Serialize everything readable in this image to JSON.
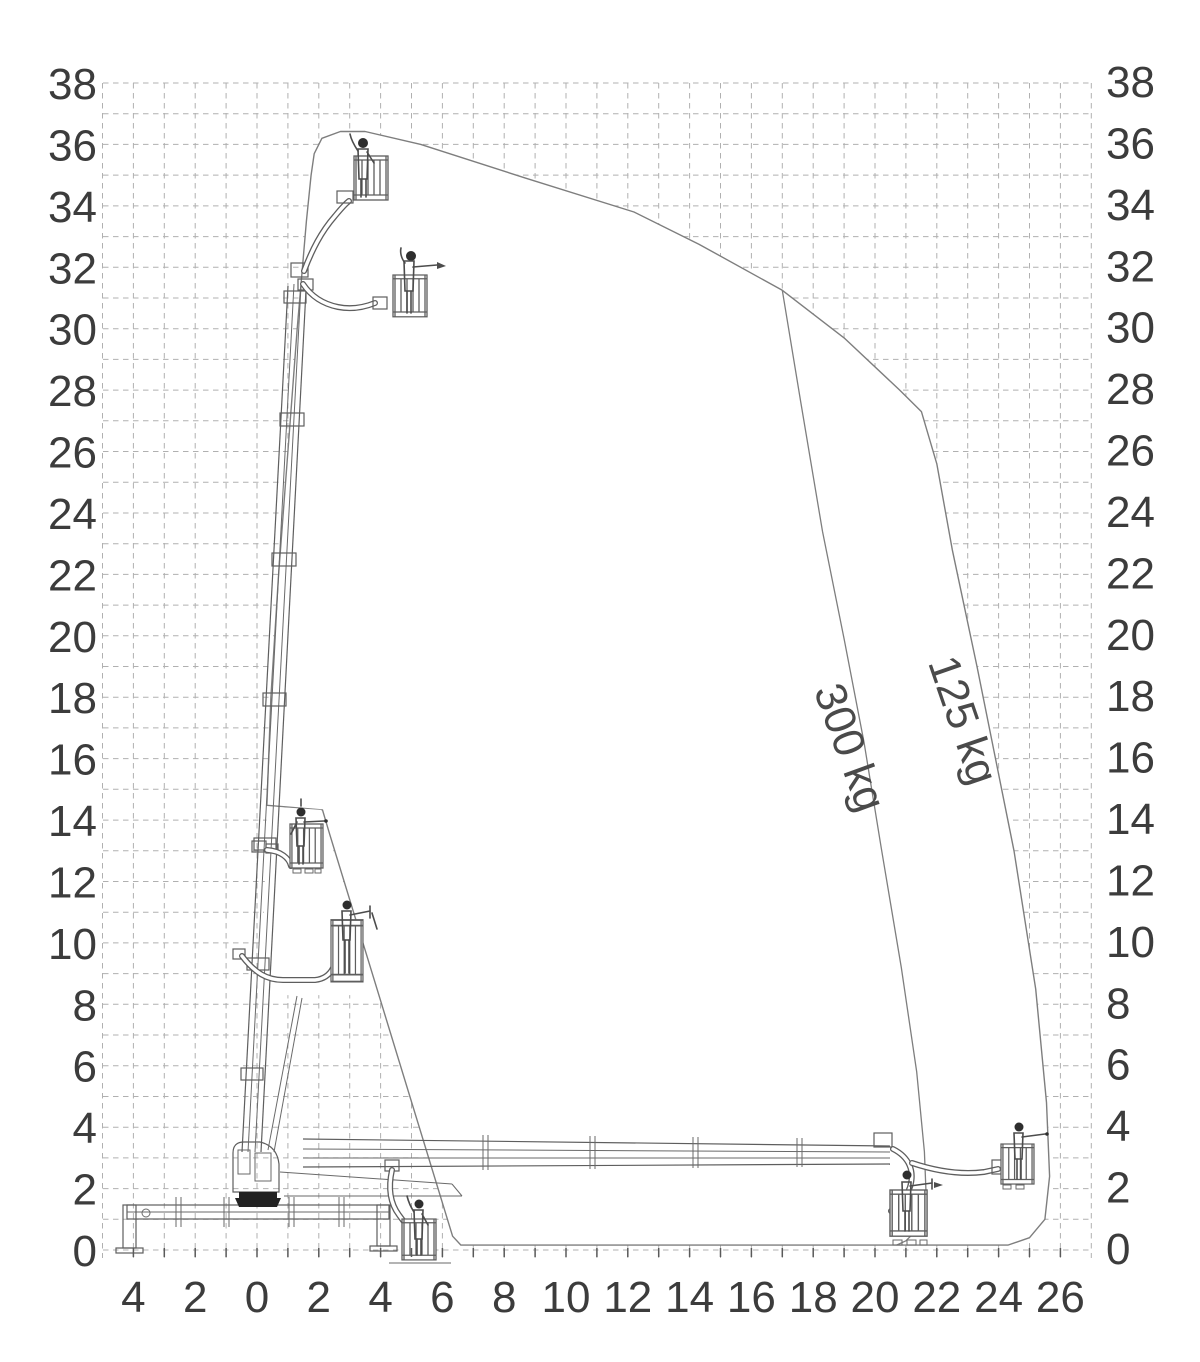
{
  "figure": {
    "kind": "aerial-work-platform working envelope diagram",
    "units": "m"
  },
  "chart_data": {
    "type": "area",
    "title": "",
    "xlabel": "",
    "ylabel": "",
    "x_axis": {
      "grid_range_m": [
        -5,
        27
      ],
      "tick_values": [
        -4,
        -2,
        0,
        2,
        4,
        6,
        8,
        10,
        12,
        14,
        16,
        18,
        20,
        22,
        24,
        26
      ],
      "tick_labels": [
        "4",
        "2",
        "0",
        "2",
        "4",
        "6",
        "8",
        "10",
        "12",
        "14",
        "16",
        "18",
        "20",
        "22",
        "24",
        "26"
      ],
      "minor_tick_step_m": 1
    },
    "y_axis": {
      "grid_range_m": [
        0,
        38
      ],
      "tick_values": [
        0,
        2,
        4,
        6,
        8,
        10,
        12,
        14,
        16,
        18,
        20,
        22,
        24,
        26,
        28,
        30,
        32,
        34,
        36,
        38
      ],
      "tick_labels": [
        "0",
        "2",
        "4",
        "6",
        "8",
        "10",
        "12",
        "14",
        "16",
        "18",
        "20",
        "22",
        "24",
        "26",
        "28",
        "30",
        "32",
        "34",
        "36",
        "38"
      ],
      "sides": [
        "left",
        "right"
      ]
    },
    "grid": {
      "spacing_m": 1,
      "style": "dashed",
      "on": true
    },
    "series": [
      {
        "name": "125 kg envelope",
        "load_kg": 125,
        "closed": true,
        "points_m": [
          [
            1.85,
            35.7
          ],
          [
            2.1,
            36.2
          ],
          [
            2.7,
            36.42
          ],
          [
            3.5,
            36.42
          ],
          [
            5.3,
            36.0
          ],
          [
            8.7,
            34.9
          ],
          [
            12.2,
            33.8
          ],
          [
            14.3,
            32.75
          ],
          [
            17.0,
            31.25
          ],
          [
            19.0,
            29.7
          ],
          [
            20.8,
            28.0
          ],
          [
            21.5,
            27.3
          ],
          [
            22.0,
            25.6
          ],
          [
            22.5,
            22.8
          ],
          [
            23.3,
            19.0
          ],
          [
            24.5,
            13.0
          ],
          [
            25.2,
            8.5
          ],
          [
            25.55,
            4.8
          ],
          [
            25.65,
            2.4
          ],
          [
            25.5,
            1.0
          ],
          [
            25.0,
            0.4
          ],
          [
            24.3,
            0.16
          ],
          [
            6.6,
            0.16
          ],
          [
            6.33,
            0.45
          ],
          [
            2.35,
            13.55
          ],
          [
            2.12,
            14.33
          ],
          [
            0.32,
            14.48
          ],
          [
            0.45,
            18.0
          ],
          [
            0.7,
            22.0
          ],
          [
            1.0,
            26.0
          ],
          [
            1.3,
            30.0
          ],
          [
            1.6,
            33.5
          ],
          [
            1.75,
            35.0
          ]
        ]
      },
      {
        "name": "300 kg limit",
        "load_kg": 300,
        "closed": false,
        "points_m": [
          [
            17.0,
            31.25
          ],
          [
            17.6,
            27.6
          ],
          [
            18.3,
            23.4
          ],
          [
            19.0,
            19.9
          ],
          [
            19.65,
            16.5
          ],
          [
            20.2,
            13.1
          ],
          [
            20.85,
            9.2
          ],
          [
            21.35,
            5.8
          ],
          [
            21.6,
            3.2
          ],
          [
            21.65,
            1.9
          ],
          [
            21.5,
            0.8
          ],
          [
            21.0,
            0.3
          ],
          [
            20.7,
            0.16
          ]
        ]
      }
    ],
    "inner_fill_patch_m": [
      [
        0.32,
        14.45
      ],
      [
        2.08,
        14.33
      ],
      [
        3.82,
        8.3
      ],
      [
        0.15,
        8.3
      ]
    ],
    "annotations": [
      {
        "text": "300 kg",
        "x_m": 18.74,
        "y_m": 16.2,
        "angle_deg": 70
      },
      {
        "text": "125 kg",
        "x_m": 22.4,
        "y_m": 17.1,
        "angle_deg": 71
      }
    ],
    "machine": {
      "description": "outrigger-mounted articulated telescopic boom lift drawn in multiple working positions with operator baskets",
      "basket_positions_m": [
        [
          3.7,
          34.2
        ],
        [
          5.0,
          30.4
        ],
        [
          1.65,
          12.4
        ],
        [
          2.9,
          8.7
        ],
        [
          5.3,
          -0.2
        ],
        [
          21.2,
          0.5
        ],
        [
          24.8,
          2.2
        ]
      ],
      "max_height_m": 36.4,
      "max_outreach_m": 25.65
    }
  },
  "style": {
    "background": "#ffffff",
    "grid_color": "#b0b0b0",
    "envelope_stroke": "#7e7e7e",
    "label_color": "#3c3c3c",
    "machine_line_color": "#5e5e5e"
  }
}
